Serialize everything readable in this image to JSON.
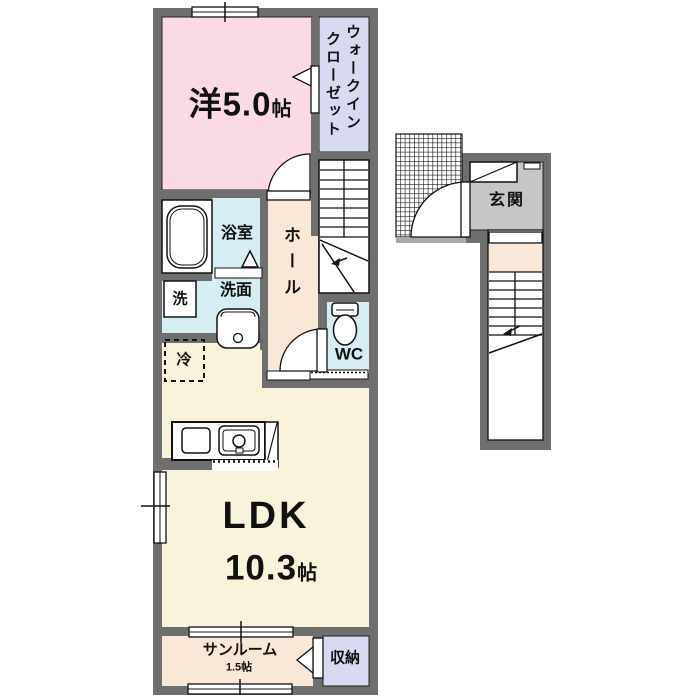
{
  "plan_title": "2F apartment floor plan",
  "colors": {
    "wall": "#6f6f6f",
    "western_room_pink": "#fbdbe3",
    "closet_lavender": "#d8daf2",
    "water_area_blue": "#d6edf4",
    "hall_peach": "#f9e7d7",
    "ldk_cream": "#faf3dc",
    "entrance_gray": "#c6c6c6",
    "porch_edge_gray": "#a9a9a9",
    "line": "#111111"
  },
  "rooms": {
    "western": {
      "label": "洋5.0",
      "unit": "帖"
    },
    "walk_in_closet": {
      "line1": "ウォークイン",
      "line2": "クローゼット"
    },
    "bathroom": {
      "label": "浴室"
    },
    "washer": {
      "label": "洗"
    },
    "washroom": {
      "label": "洗面"
    },
    "hall": {
      "label": "ホール"
    },
    "toilet": {
      "label": "WC"
    },
    "refrigerator": {
      "label": "冷"
    },
    "ldk": {
      "label": "LDK",
      "size": "10.3",
      "unit": "帖"
    },
    "sunroom": {
      "label": "サンルーム",
      "size": "1.5帖"
    },
    "storage": {
      "label": "収納"
    },
    "entrance": {
      "label": "玄関"
    }
  }
}
